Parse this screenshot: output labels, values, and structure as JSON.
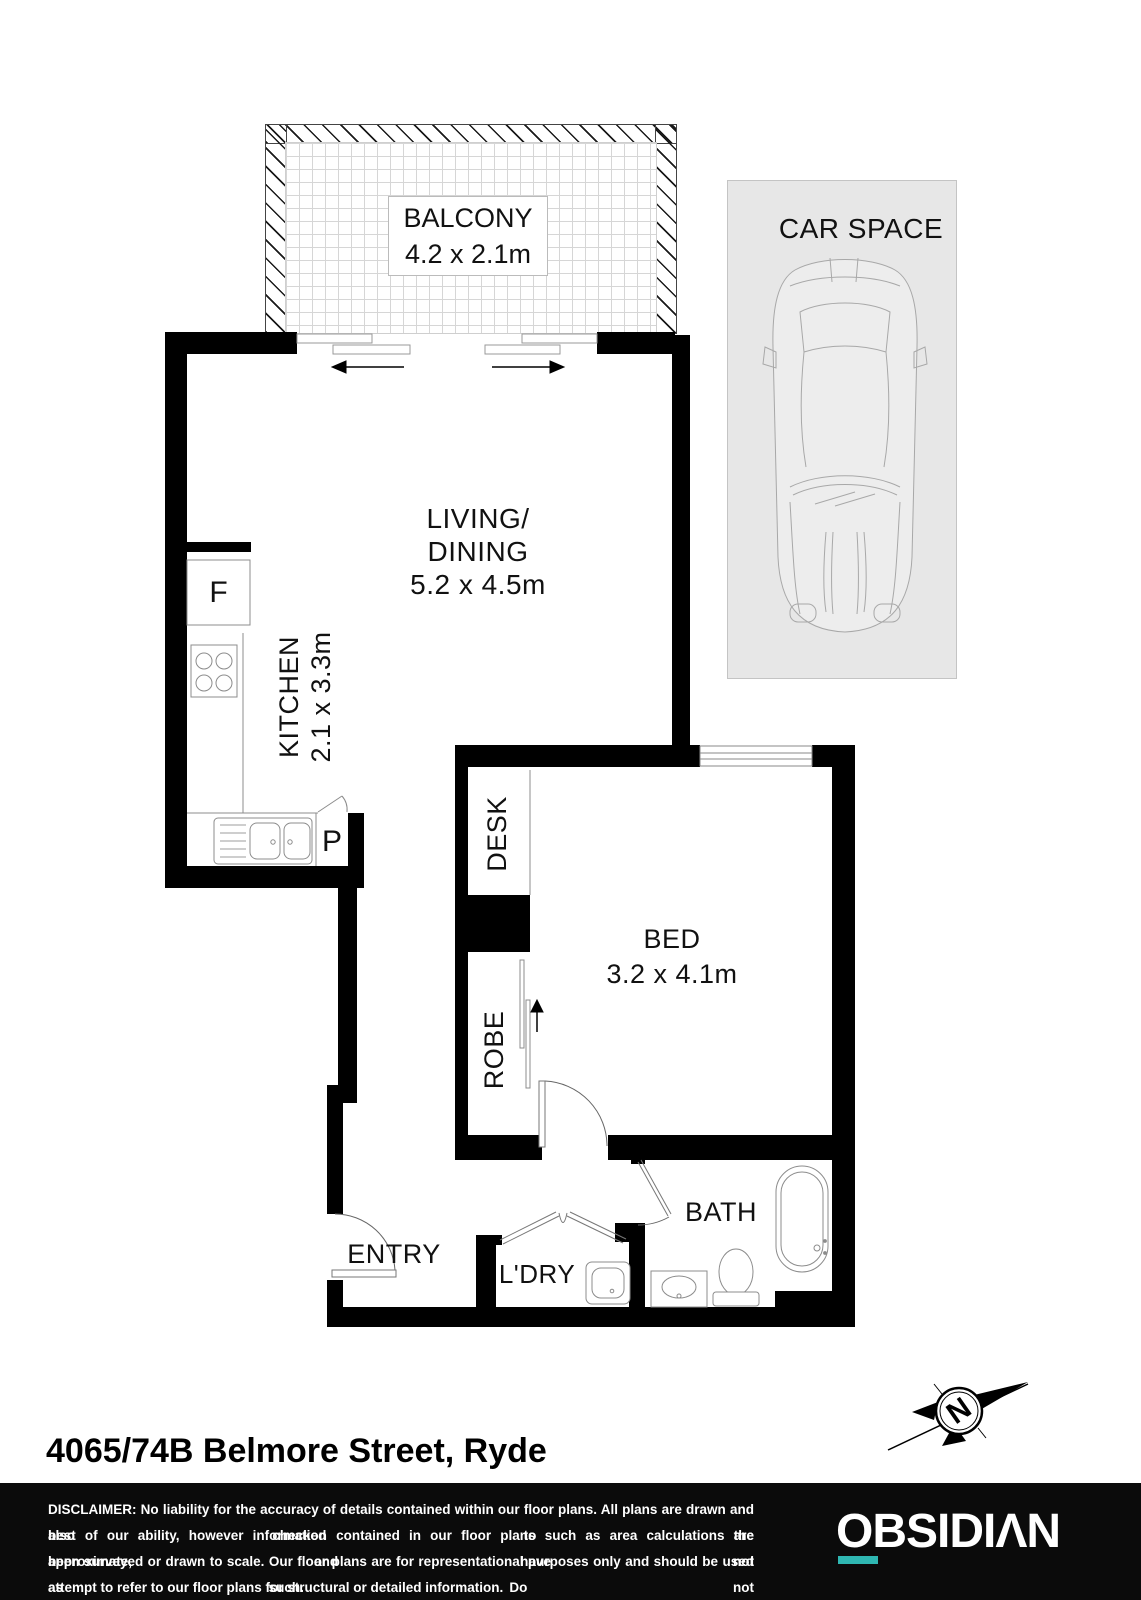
{
  "plan": {
    "address": "4065/74B Belmore Street, Ryde",
    "rooms": {
      "balcony": {
        "label": "BALCONY",
        "dims": "4.2 x 2.1m"
      },
      "car_space": {
        "label": "CAR SPACE"
      },
      "living_dining": {
        "line1": "LIVING/",
        "line2": "DINING",
        "dims": "5.2 x 4.5m"
      },
      "kitchen": {
        "label": "KITCHEN",
        "dims": "2.1 x 3.3m"
      },
      "bed": {
        "label": "BED",
        "dims": "3.2 x 4.1m"
      },
      "bath": {
        "label": "BATH"
      },
      "laundry": {
        "label": "L'DRY"
      },
      "entry": {
        "label": "ENTRY"
      },
      "desk": {
        "label": "DESK"
      },
      "robe": {
        "label": "ROBE"
      }
    },
    "markers": {
      "fridge": "F",
      "pantry": "P"
    },
    "compass": {
      "north": "N"
    }
  },
  "footer": {
    "disclaimer_lines": [
      "DISCLAIMER: No liability for the accuracy of details contained within our floor plans. All plans are drawn and also checked to the",
      "best of our ability, however information contained in our floor plans such as area calculations are approximate, and have not",
      "been surveyed or drawn to scale. Our floor plans are for representational purposes only and should be used as such. Do not",
      "attempt to refer to our floor plans for structural or detailed information."
    ],
    "logo_text": "OBSIDIΛN"
  },
  "colors": {
    "wall": "#000000",
    "carspace_fill": "#e7e7e7",
    "accent_teal": "#2FB7B2",
    "footer_bg": "#0b0b0b"
  }
}
